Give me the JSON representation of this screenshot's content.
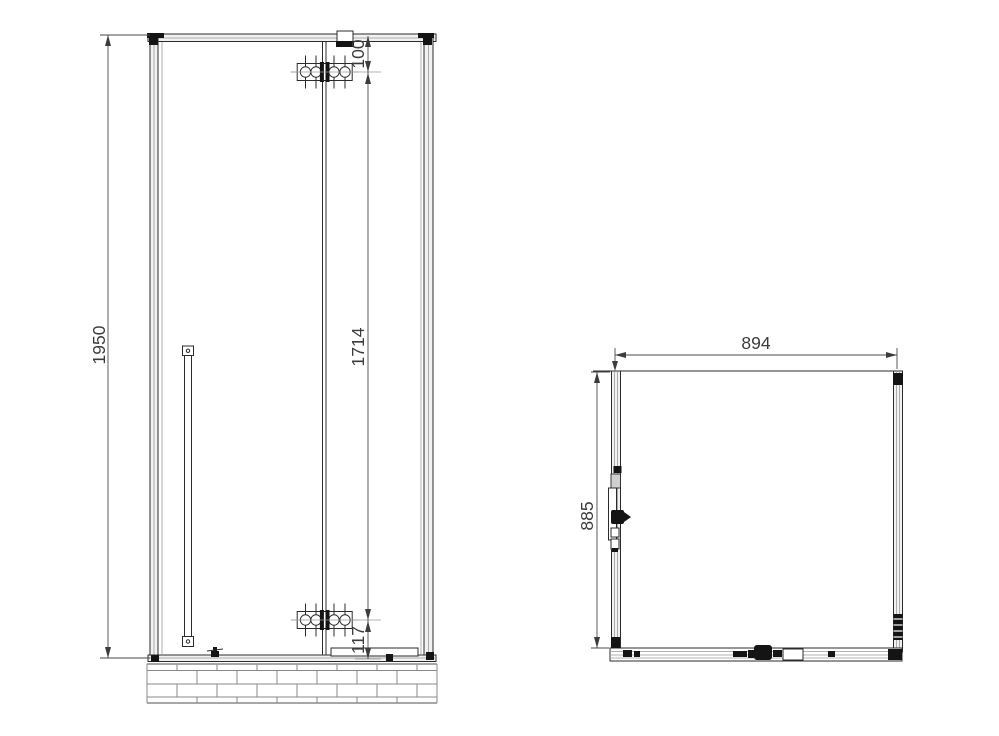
{
  "drawing": {
    "kind": "shower-enclosure-technical-drawing",
    "colors": {
      "background": "#ffffff",
      "line": "#2b2b2b",
      "hardware": "#141414",
      "dim_text": "#3c3c3c",
      "mortar": "#8a8a8a"
    }
  },
  "views": {
    "front": {
      "overall_height": "1950",
      "top_hinge_offset": "100",
      "hinge_distance": "1714",
      "bottom_hinge_offset": "117"
    },
    "plan": {
      "overall_width": "894",
      "overall_depth": "885"
    }
  }
}
